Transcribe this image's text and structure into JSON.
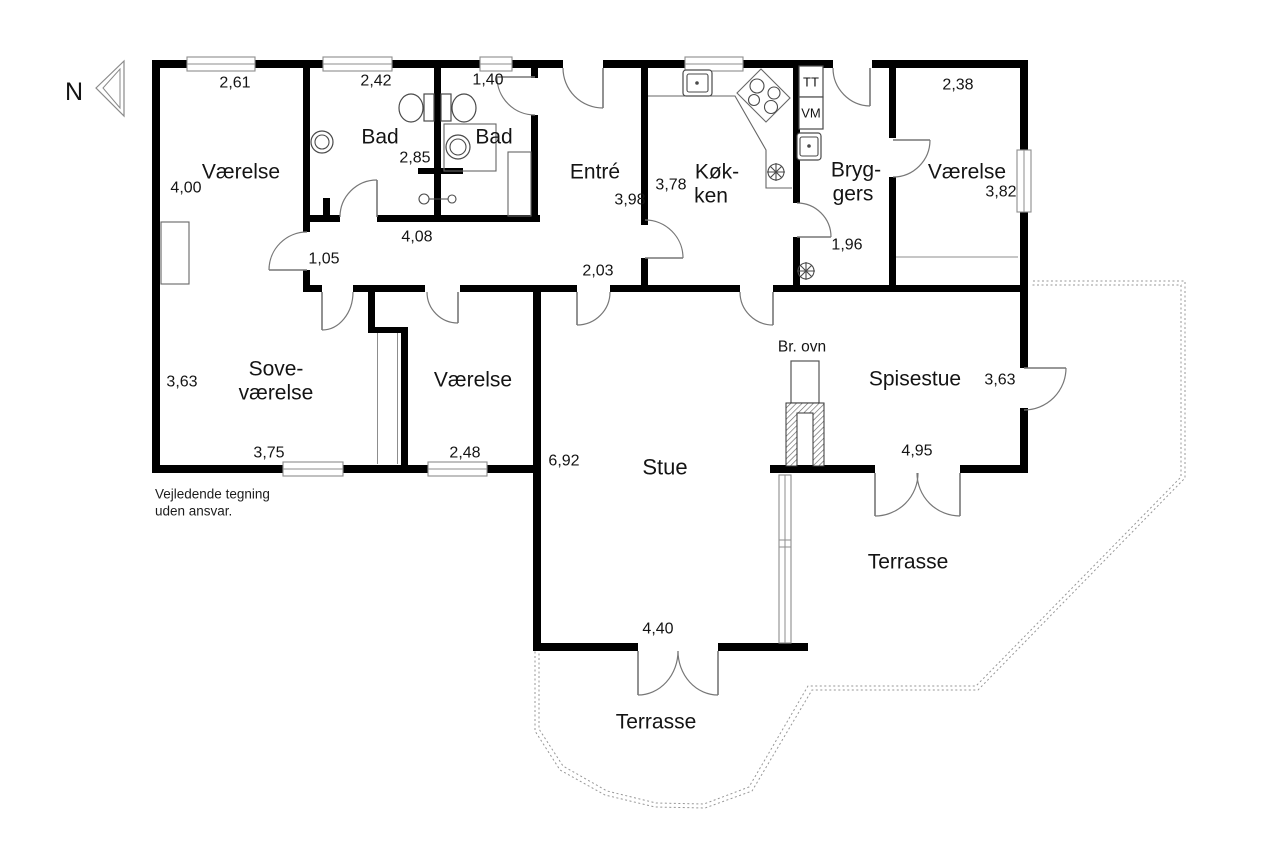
{
  "north": {
    "label": "N"
  },
  "rooms": {
    "vaerelse_nw": {
      "label": "Værelse",
      "dim_top": "2,61",
      "dim_left": "4,00"
    },
    "bad1": {
      "label": "Bad",
      "dim_top": "2,42",
      "dim_right": "2,85"
    },
    "bad2": {
      "label": "Bad",
      "dim_top": "1,40"
    },
    "entre": {
      "label": "Entré",
      "dim": "3,98"
    },
    "koekken": {
      "line1": "Køk-",
      "line2": "ken",
      "dim": "3,78"
    },
    "bryggers": {
      "line1": "Bryg-",
      "line2": "gers",
      "dim": "1,96"
    },
    "vaerelse_ne": {
      "label": "Værelse",
      "dim_top": "2,38",
      "dim_right": "3,82"
    },
    "sovevaerelse": {
      "line1": "Sove-",
      "line2": "værelse",
      "dim_left": "3,63",
      "dim_bottom": "3,75"
    },
    "vaerelse_s": {
      "label": "Værelse",
      "dim_bottom": "2,48"
    },
    "stue": {
      "label": "Stue",
      "dim_left": "6,92",
      "dim_bottom": "4,40"
    },
    "spisestue": {
      "label": "Spisestue",
      "dim_right": "3,63",
      "dim_bottom": "4,95"
    },
    "terrasse_s": {
      "label": "Terrasse"
    },
    "terrasse_e": {
      "label": "Terrasse"
    }
  },
  "hallway": {
    "dim_length": "4,08",
    "dim_width": "1,05",
    "dim_passage": "2,03"
  },
  "labels": {
    "tt": "TT",
    "vm": "VM",
    "wood_stove": "Br. ovn"
  },
  "footer": {
    "line1": "Vejledende tegning",
    "line2": "uden ansvar."
  }
}
